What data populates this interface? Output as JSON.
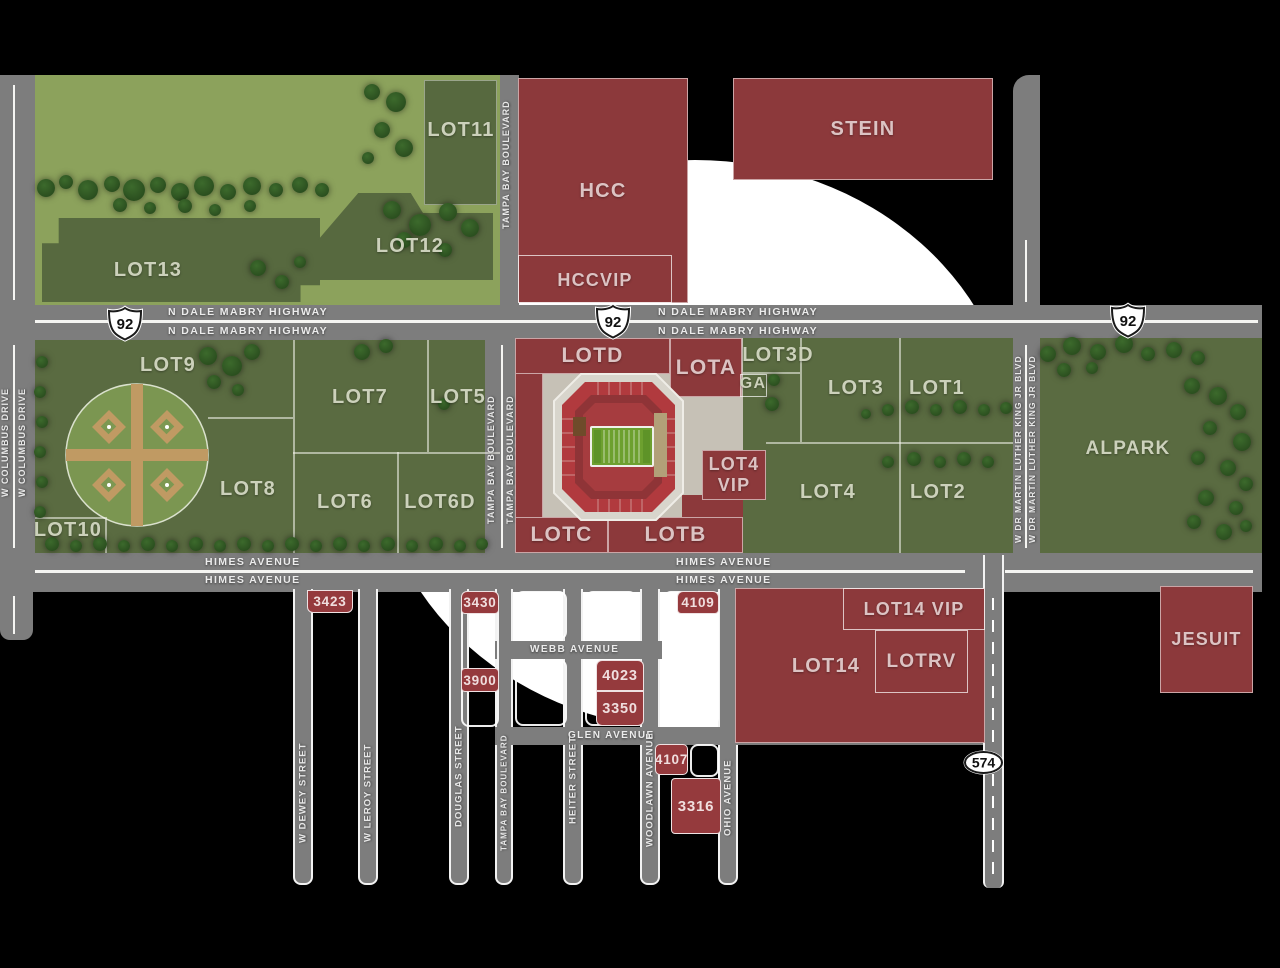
{
  "colors": {
    "lot_red": "#8c393b",
    "lot_green": "#5a6b41",
    "park_green": "#8ca25c",
    "dark_green_lot": "#57693f",
    "road_gray": "#7d7d7d",
    "plaza": "#c6c1b6",
    "field_green": "#6da02f",
    "tree_green": "#2f5323",
    "circle_white": "#ffffff"
  },
  "roads": {
    "n_dale_mabry": "N DALE MABRY HIGHWAY",
    "himes": "HIMES AVENUE",
    "tampa_bay": "TAMPA BAY BOULEVARD",
    "w_columbus": "W COLUMBUS DRIVE",
    "mlk": "W DR MARTIN LUTHER KING JR BLVD",
    "webb": "WEBB AVENUE",
    "glen": "GLEN AVENUE",
    "dewey": "W DEWEY STREET",
    "leroy": "W LEROY STREET",
    "douglas": "DOUGLAS STREET",
    "heiter": "HEITER STREET",
    "woodlawn": "WOODLAWN AVENUE",
    "ohio": "OHIO AVENUE"
  },
  "shields": {
    "us_92": "92",
    "fl_574": "574"
  },
  "lots": {
    "hcc": "HCC",
    "hccvip": "HCCVIP",
    "stein": "STEIN",
    "lot11": "LOT11",
    "lot12": "LOT12",
    "lot13": "LOT13",
    "lot9": "LOT9",
    "lot7": "LOT7",
    "lot5": "LOT5",
    "lot8": "LOT8",
    "lot6": "LOT6",
    "lot6d": "LOT6D",
    "lot10": "LOT10",
    "lotd": "LOTD",
    "lota": "LOTA",
    "lotc": "LOTC",
    "lotb": "LOTB",
    "lot3d": "LOT3D",
    "ga": "GA",
    "lot4vip_line1": "LOT4",
    "lot4vip_line2": "VIP",
    "lot3": "LOT3",
    "lot1": "LOT1",
    "lot4": "LOT4",
    "lot2": "LOT2",
    "alpark": "ALPARK",
    "lot14": "LOT14",
    "lot14vip": "LOT14 VIP",
    "lotrv": "LOTRV",
    "jesuit": "JESUIT",
    "b3423": "3423",
    "b3430": "3430",
    "b3900": "3900",
    "b4023": "4023",
    "b3350": "3350",
    "b4109": "4109",
    "b4107": "4107",
    "b3316": "3316"
  },
  "trees": [
    [
      46,
      188,
      18
    ],
    [
      66,
      182,
      14
    ],
    [
      88,
      190,
      20
    ],
    [
      112,
      184,
      16
    ],
    [
      134,
      190,
      22
    ],
    [
      158,
      185,
      16
    ],
    [
      180,
      192,
      18
    ],
    [
      204,
      186,
      20
    ],
    [
      228,
      192,
      16
    ],
    [
      252,
      186,
      18
    ],
    [
      276,
      190,
      14
    ],
    [
      300,
      185,
      16
    ],
    [
      322,
      190,
      14
    ],
    [
      120,
      205,
      14
    ],
    [
      150,
      208,
      12
    ],
    [
      185,
      206,
      14
    ],
    [
      215,
      210,
      12
    ],
    [
      250,
      206,
      12
    ],
    [
      372,
      92,
      16
    ],
    [
      396,
      102,
      20
    ],
    [
      382,
      130,
      16
    ],
    [
      404,
      148,
      18
    ],
    [
      368,
      158,
      12
    ],
    [
      392,
      210,
      18
    ],
    [
      420,
      225,
      22
    ],
    [
      448,
      212,
      18
    ],
    [
      404,
      240,
      16
    ],
    [
      470,
      228,
      18
    ],
    [
      445,
      250,
      14
    ],
    [
      258,
      268,
      16
    ],
    [
      282,
      282,
      14
    ],
    [
      300,
      262,
      12
    ],
    [
      42,
      362,
      12
    ],
    [
      40,
      392,
      12
    ],
    [
      42,
      422,
      12
    ],
    [
      40,
      452,
      12
    ],
    [
      42,
      482,
      12
    ],
    [
      40,
      512,
      12
    ],
    [
      208,
      356,
      18
    ],
    [
      232,
      366,
      20
    ],
    [
      252,
      352,
      16
    ],
    [
      214,
      382,
      14
    ],
    [
      238,
      390,
      12
    ],
    [
      362,
      352,
      16
    ],
    [
      386,
      346,
      14
    ],
    [
      444,
      404,
      12
    ],
    [
      52,
      544,
      14
    ],
    [
      76,
      546,
      12
    ],
    [
      100,
      544,
      14
    ],
    [
      124,
      546,
      12
    ],
    [
      148,
      544,
      14
    ],
    [
      172,
      546,
      12
    ],
    [
      196,
      544,
      14
    ],
    [
      220,
      546,
      12
    ],
    [
      244,
      544,
      14
    ],
    [
      268,
      546,
      12
    ],
    [
      292,
      544,
      14
    ],
    [
      316,
      546,
      12
    ],
    [
      340,
      544,
      14
    ],
    [
      364,
      546,
      12
    ],
    [
      388,
      544,
      14
    ],
    [
      412,
      546,
      12
    ],
    [
      436,
      544,
      14
    ],
    [
      460,
      546,
      12
    ],
    [
      482,
      544,
      12
    ],
    [
      774,
      380,
      12
    ],
    [
      772,
      404,
      14
    ],
    [
      866,
      414,
      10
    ],
    [
      888,
      410,
      12
    ],
    [
      912,
      407,
      14
    ],
    [
      936,
      410,
      12
    ],
    [
      960,
      407,
      14
    ],
    [
      984,
      410,
      12
    ],
    [
      1006,
      408,
      12
    ],
    [
      888,
      462,
      12
    ],
    [
      914,
      459,
      14
    ],
    [
      940,
      462,
      12
    ],
    [
      964,
      459,
      14
    ],
    [
      988,
      462,
      12
    ],
    [
      1048,
      354,
      16
    ],
    [
      1072,
      346,
      18
    ],
    [
      1098,
      352,
      16
    ],
    [
      1124,
      344,
      18
    ],
    [
      1148,
      354,
      14
    ],
    [
      1174,
      350,
      16
    ],
    [
      1198,
      358,
      14
    ],
    [
      1064,
      370,
      14
    ],
    [
      1092,
      368,
      12
    ],
    [
      1192,
      386,
      16
    ],
    [
      1218,
      396,
      18
    ],
    [
      1238,
      412,
      16
    ],
    [
      1210,
      428,
      14
    ],
    [
      1242,
      442,
      18
    ],
    [
      1198,
      458,
      14
    ],
    [
      1228,
      468,
      16
    ],
    [
      1246,
      484,
      14
    ],
    [
      1206,
      498,
      16
    ],
    [
      1236,
      508,
      14
    ],
    [
      1194,
      522,
      14
    ],
    [
      1224,
      532,
      16
    ],
    [
      1246,
      526,
      12
    ]
  ]
}
